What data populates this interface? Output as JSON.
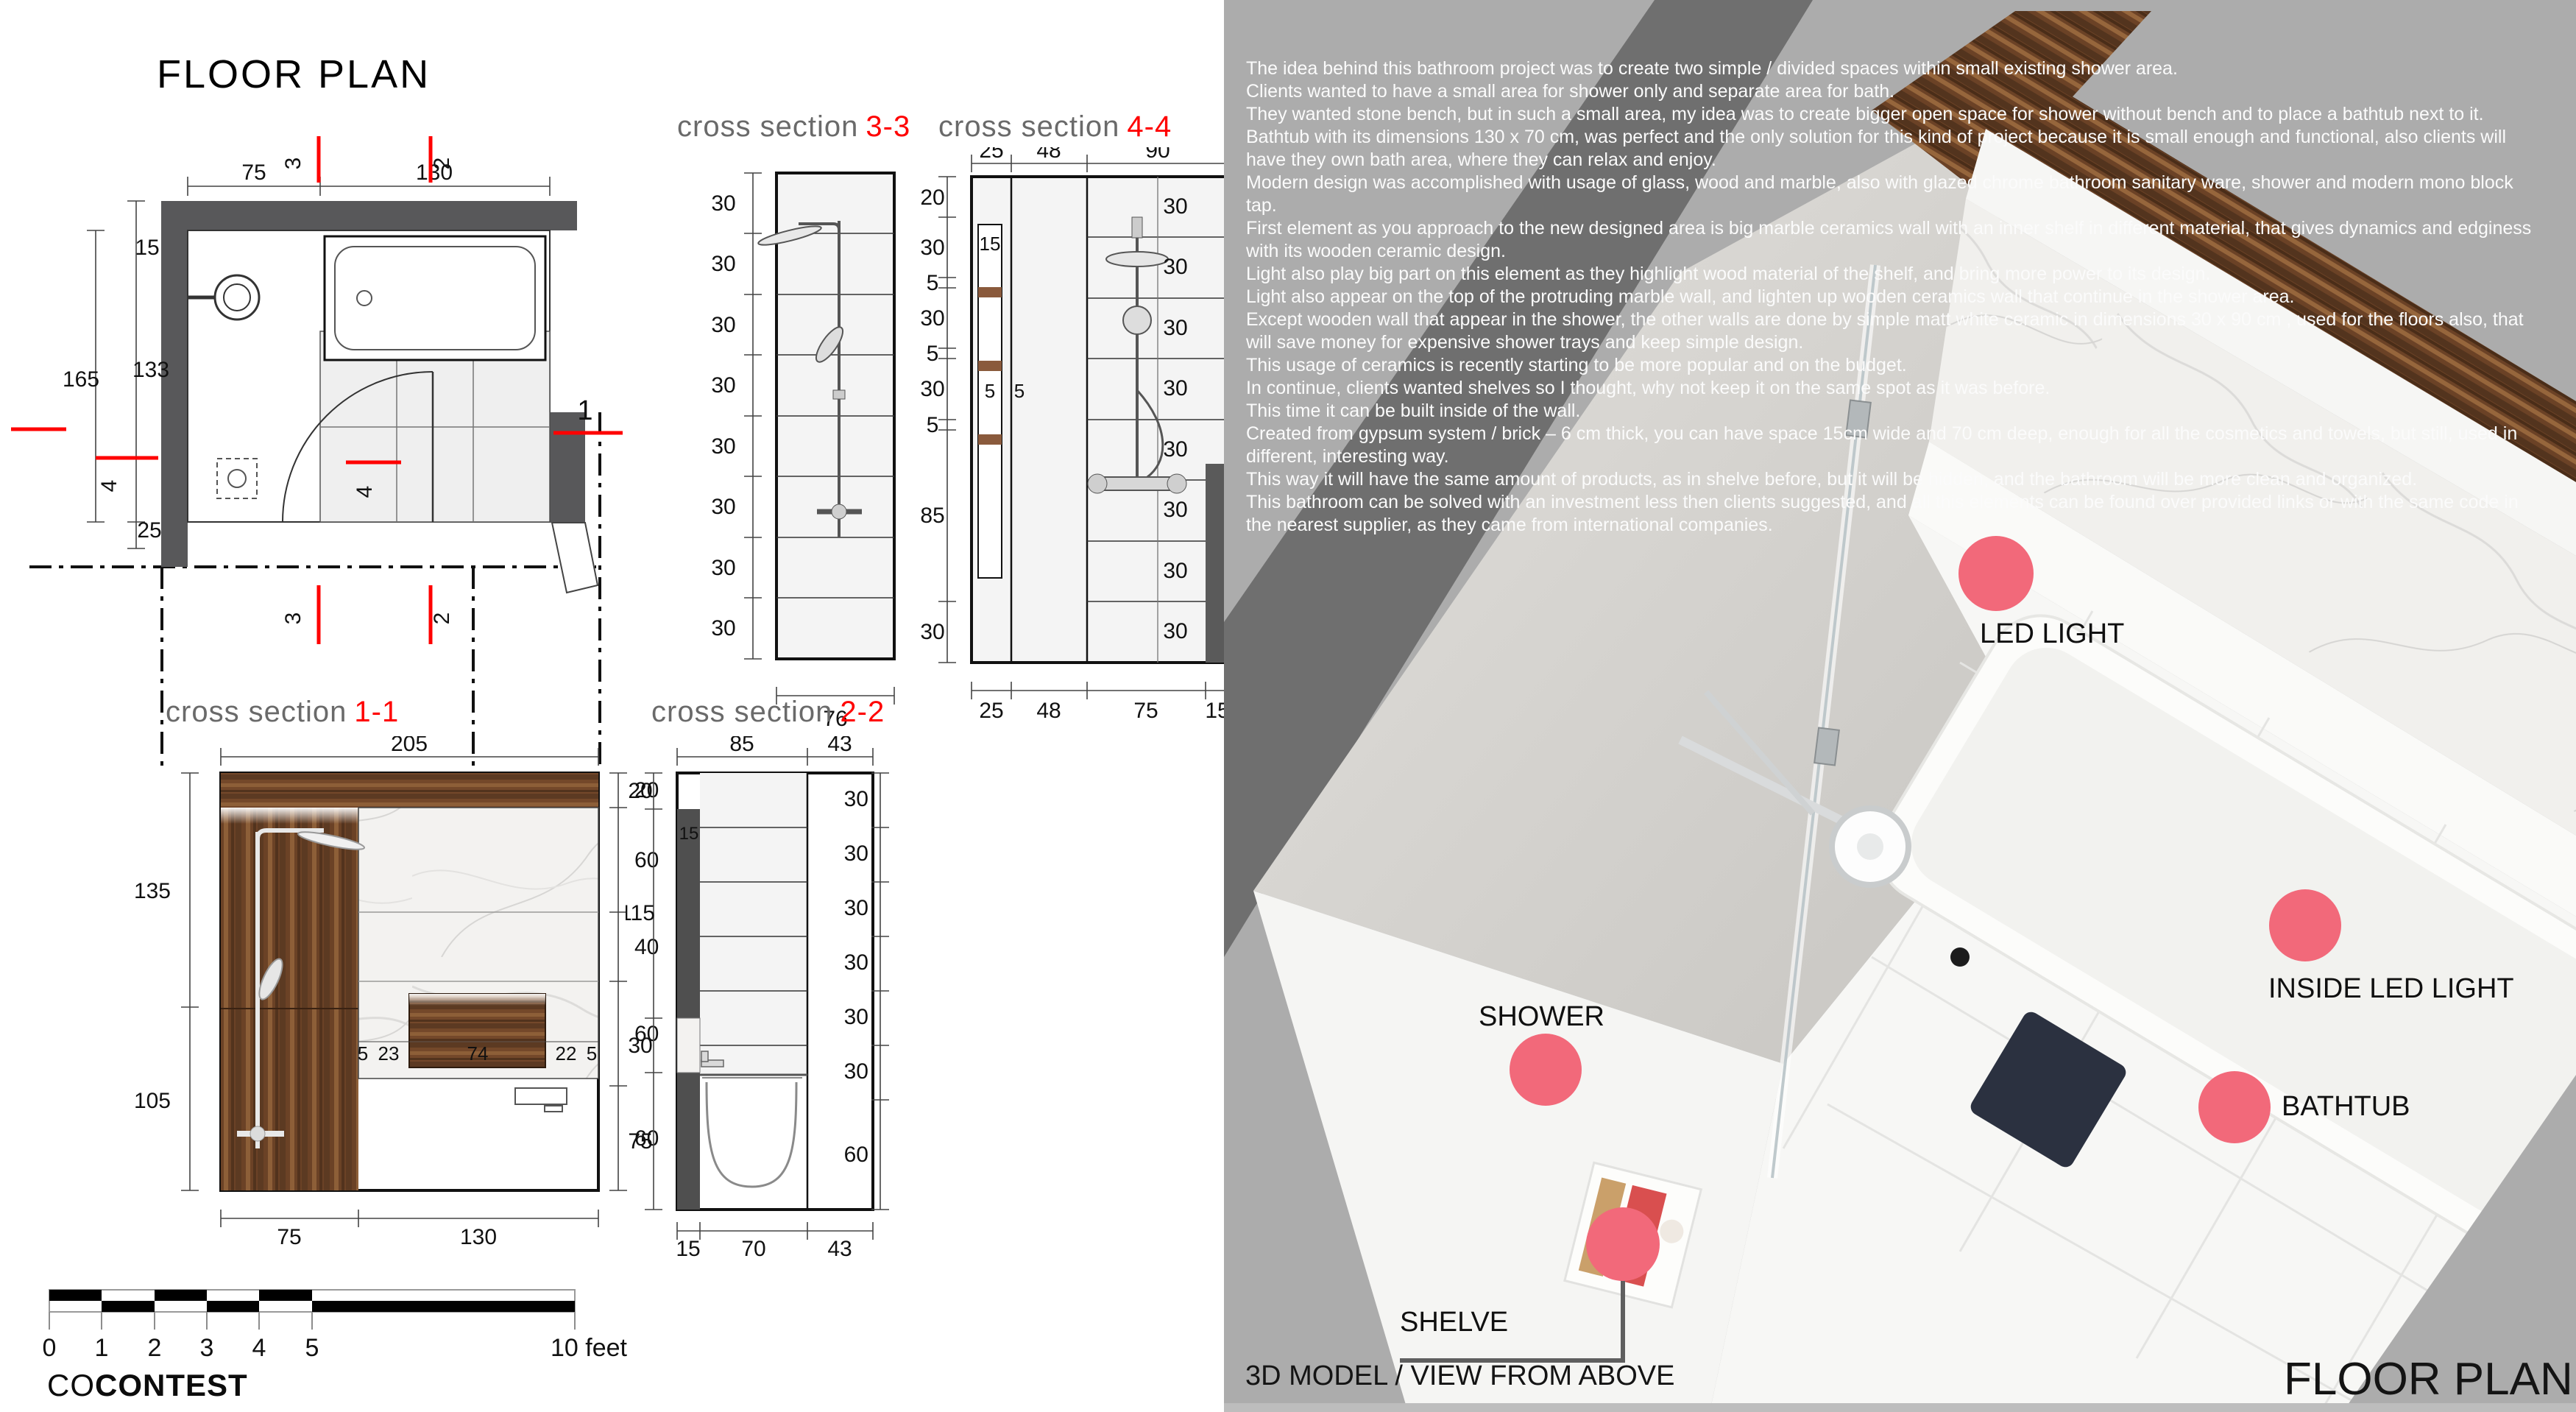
{
  "left_panel": {
    "title": "FLOOR PLAN",
    "cs_prefix": "cross section",
    "plan": {
      "top": [
        "75",
        "130"
      ],
      "left": [
        "15",
        "165",
        "133",
        "25"
      ],
      "m1": "1",
      "m2": "2",
      "m3": "3",
      "m4": "4"
    },
    "cs33": {
      "num": "3-3",
      "rows": [
        "30",
        "30",
        "30",
        "30",
        "30",
        "30",
        "30",
        "30"
      ],
      "bottom": "76"
    },
    "cs44": {
      "num": "4-4",
      "top": [
        "25",
        "48",
        "90"
      ],
      "left": [
        "20",
        "30",
        "5",
        "30",
        "5",
        "30",
        "5",
        "85",
        "30"
      ],
      "inner": [
        "15",
        "5",
        "5"
      ],
      "tiles": [
        "30",
        "30",
        "30",
        "30",
        "30",
        "30",
        "30",
        "30"
      ],
      "right": "240",
      "bottom": [
        "25",
        "48",
        "75",
        "15"
      ]
    },
    "cs11": {
      "num": "1-1",
      "top": "205",
      "left": [
        "135",
        "105"
      ],
      "right": [
        "20",
        "60",
        "40",
        "60",
        "60"
      ],
      "shelf": [
        "5",
        "23",
        "74",
        "22",
        "5"
      ],
      "bottom": [
        "75",
        "130"
      ]
    },
    "cs22": {
      "num": "2-2",
      "top": [
        "85",
        "43"
      ],
      "left": [
        "20",
        "115",
        "30",
        "75"
      ],
      "inner": "15",
      "right": [
        "30",
        "30",
        "30",
        "30",
        "30",
        "30",
        "60"
      ],
      "bottom": [
        "15",
        "70",
        "43"
      ]
    },
    "scale": {
      "ticks": [
        "0",
        "1",
        "2",
        "3",
        "4",
        "5"
      ],
      "end": "10 feet"
    },
    "logo": {
      "a": "CO",
      "b": "CONTEST"
    }
  },
  "right_panel": {
    "desc": [
      "The idea behind this bathroom project was to create two simple / divided spaces within small existing shower area.",
      "Clients wanted to have a small area for shower only and separate area for bath.",
      "They wanted stone bench, but in such a small area, my idea was to create bigger open space for shower without bench and to place a bathtub next to it.",
      "Bathtub with its dimensions 130 x 70 cm, was perfect and the only solution for this kind of project because it is small enough and functional, also clients will have they own bath area, where they can relax and enjoy.",
      "Modern design was accomplished with usage of glass, wood and marble, also with glazed chrome bathroom sanitary ware, shower and modern mono block tap.",
      "First element as you approach to the new designed area is big marble ceramics wall with an inner shelf in different material, that gives dynamics and edginess with its wooden ceramic design.",
      "Light also play big part on this element as they highlight wood material of the shelf, and bring more power to its design.",
      "Light also appear on the top of the protruding marble wall, and lighten up wooden ceramics wall that continue in the shower area.",
      "Except wooden wall that appear in the shower, the other walls are done by simple matt white ceramic in dimensions 30 x 90 cm , used for the floors also, that will save money for expensive shower trays and keep simple design.",
      "This usage of ceramics is recently starting to be more popular and on the budget.",
      "In continue, clients wanted shelves so I thought, why not keep it on the same spot as it was before.",
      "This time it can be built inside of the wall.",
      "Created from gypsum system / brick – 6 cm thick, you can have space 15cm wide and 70 cm deep, enough for all the cosmetics and towels, but still, used in different, interesting way.",
      "This way it will have the same amount of products, as in shelve before, but it will be hidden, and the bathroom will be more clean and organized.",
      "This bathroom can be solved with an investment less then clients suggested, and all this elements can be found over provided links or with the same code in the nearest supplier, as they came from international companies."
    ],
    "labels": {
      "led": "LED LIGHT",
      "inside_led": "INSIDE LED LIGHT",
      "shower": "SHOWER",
      "bathtub": "BATHTUB",
      "shelve": "SHELVE"
    },
    "caption": "3D MODEL / VIEW FROM ABOVE",
    "title": "FLOOR PLAN",
    "colors": {
      "accent": "#f2697a",
      "section_red": "#ff0000",
      "panel_bg": "#acacac"
    }
  }
}
